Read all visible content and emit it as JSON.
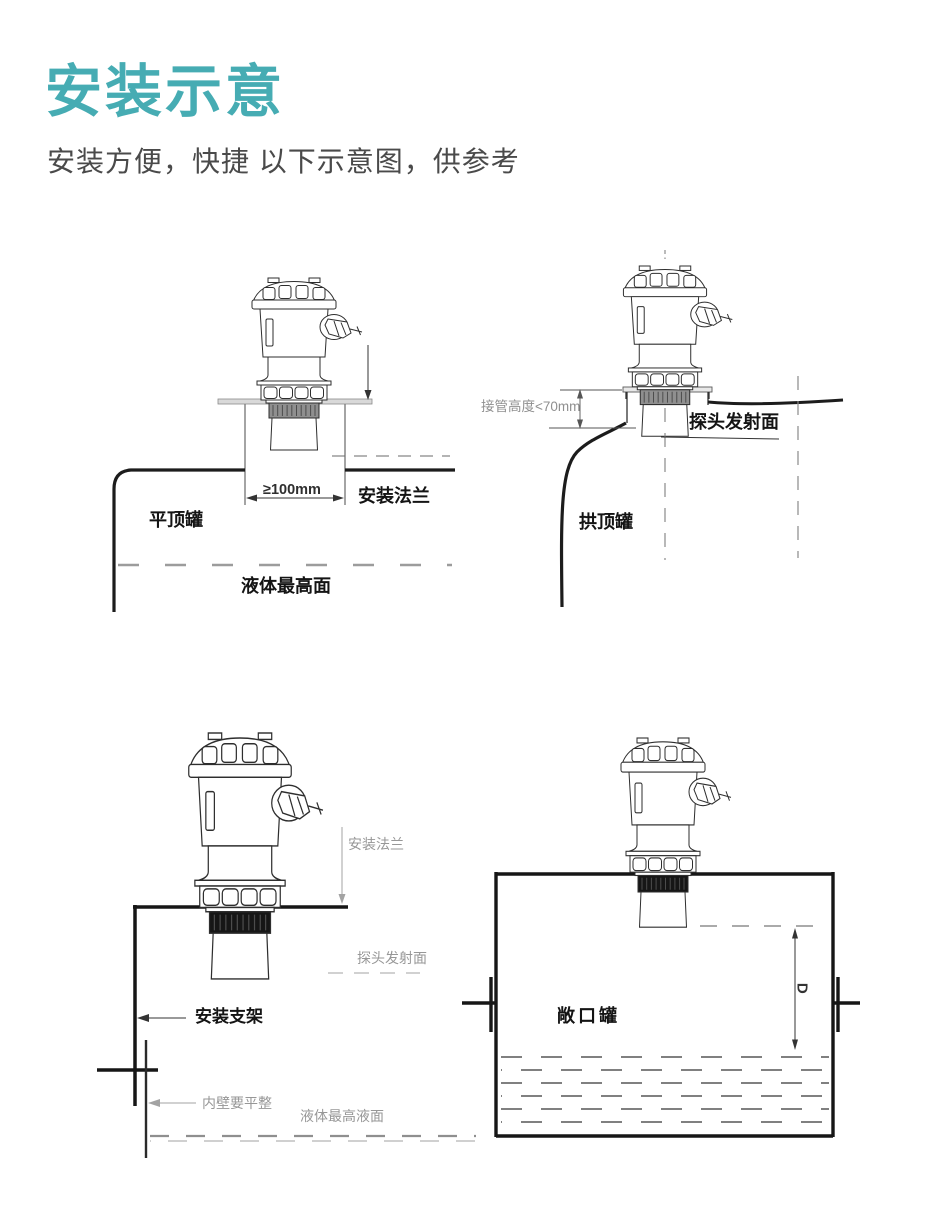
{
  "accent_color": "#46ACB3",
  "header": {
    "title": "安装示意",
    "subtitle": "安装方便，快捷 以下示意图，供参考"
  },
  "diagrams": {
    "flat_top_tank": {
      "name_label": "平顶罐",
      "min_distance": "≥100mm",
      "flange_label": "安装法兰",
      "max_liquid_label": "液体最高面"
    },
    "dome_top_tank": {
      "name_label": "拱顶罐",
      "nozzle_height": "接管高度<70mm",
      "probe_face_label": "探头发射面"
    },
    "bracket_mount": {
      "flange_label": "安装法兰",
      "probe_face_label": "探头发射面",
      "bracket_label": "安装支架",
      "wall_note": "内壁要平整",
      "max_liquid_label": "液体最高液面"
    },
    "open_tank": {
      "name_label": "敞口罐",
      "blind_zone_dim": "D"
    }
  }
}
